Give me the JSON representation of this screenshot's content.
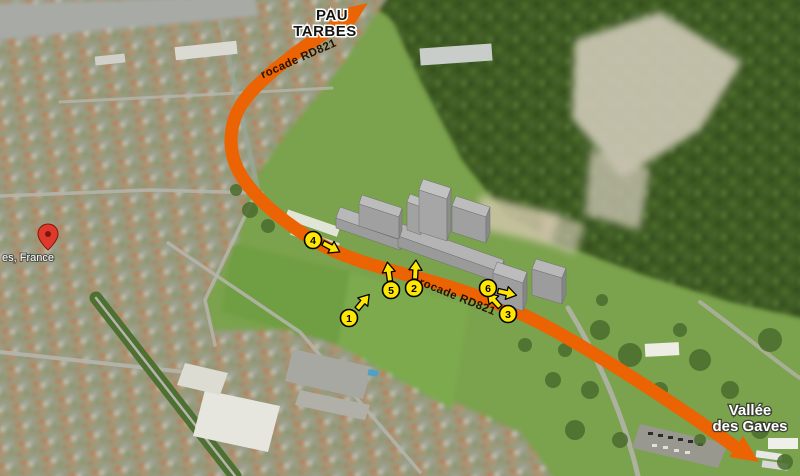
{
  "map": {
    "destination_north": {
      "line1": "PAU",
      "line2": "TARBES"
    },
    "destination_southeast": {
      "line1": "Vallée",
      "line2": "des Gaves"
    },
    "road": {
      "name_upper": "rocade RD821",
      "name_lower": "rocade RD821",
      "color": "#EC6303"
    },
    "place_label": "es, France",
    "markers": [
      {
        "label": "1",
        "arrow_direction": "north-east"
      },
      {
        "label": "2",
        "arrow_direction": "north"
      },
      {
        "label": "3",
        "arrow_direction": "north-west"
      },
      {
        "label": "4",
        "arrow_direction": "south-east"
      },
      {
        "label": "5",
        "arrow_direction": "north"
      },
      {
        "label": "6",
        "arrow_direction": "east"
      }
    ],
    "marker_style": {
      "fill": "#FFE603",
      "border": "#000000"
    }
  }
}
